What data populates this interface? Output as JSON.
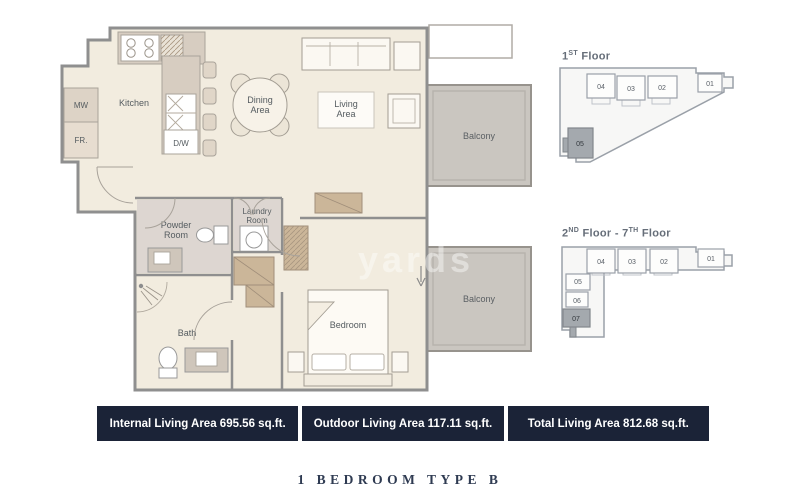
{
  "plan": {
    "labels": {
      "kitchen": "Kitchen",
      "mw": "MW",
      "fr": "FR.",
      "dw": "D/W",
      "dining1": "Dining",
      "dining2": "Area",
      "living1": "Living",
      "living2": "Area",
      "powder1": "Powder",
      "powder2": "Room",
      "laundry1": "Laundry",
      "laundry2": "Room",
      "bath": "Bath",
      "bedroom": "Bedroom",
      "balcony_top": "Balcony",
      "balcony_bottom": "Balcony"
    },
    "watermark": "yards"
  },
  "key_plans": {
    "first": {
      "title_num": "1",
      "title_sup": "ST",
      "title_rest": " Floor",
      "units": {
        "u01": "01",
        "u02": "02",
        "u03": "03",
        "u04": "04",
        "u05": "05"
      },
      "highlighted_unit": "05"
    },
    "upper": {
      "t1": "2",
      "s1": "ND",
      "t2": " Floor - 7",
      "s2": "TH",
      "t3": " Floor",
      "units": {
        "u01": "01",
        "u02": "02",
        "u03": "03",
        "u04": "04",
        "u05": "05",
        "u06": "06",
        "u07": "07"
      },
      "highlighted_unit": "07"
    }
  },
  "summary": {
    "internal": "Internal Living Area 695.56 sq.ft.",
    "outdoor": "Outdoor Living Area 117.11 sq.ft.",
    "total": "Total Living Area 812.68 sq.ft."
  },
  "page_title": "1 BEDROOM TYPE B",
  "colors": {
    "banner_bg": "#1b2337",
    "plan_floor": "#f2ecdf",
    "balcony_fill": "#cac6c0",
    "wall_stroke": "#8f8f8f",
    "counter_fill": "#d7cdc1",
    "wood_fill": "#cbb699",
    "highlight_unit": "#a4a9ae"
  }
}
